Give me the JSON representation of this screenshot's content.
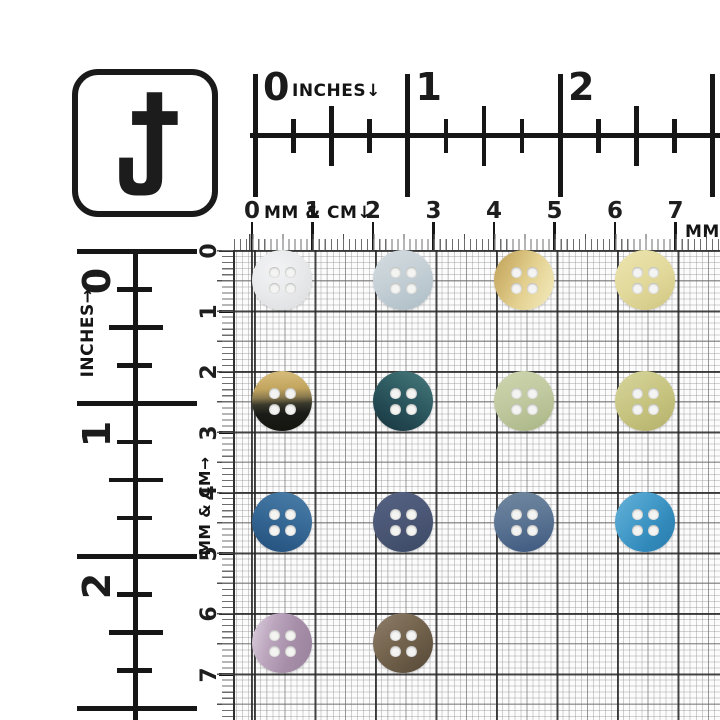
{
  "logo": {
    "letter": "J"
  },
  "rulers": {
    "top_inches": {
      "label": "INCHES↓",
      "numbers": [
        "0",
        "1",
        "2"
      ]
    },
    "top_cm": {
      "label": "MM & CM↓",
      "numbers": [
        "0",
        "1",
        "2",
        "3",
        "4",
        "5",
        "6",
        "7"
      ],
      "right_label": "MM"
    },
    "left_inches": {
      "label": "INCHES→",
      "numbers": [
        "0",
        "1",
        "2"
      ]
    },
    "left_cm": {
      "label": "MM & CM→",
      "numbers": [
        "0",
        "1",
        "2",
        "3",
        "4",
        "5",
        "6",
        "7"
      ]
    }
  },
  "grid": {
    "cm_line_color": "#2f2f2f",
    "mm_line_color": "#878787",
    "paper_color": "#fcfcfc"
  },
  "buttons": [
    {
      "name": "white-pearl-button",
      "row": 1,
      "col": 1,
      "holes": 4,
      "bg": "radial-gradient(circle at 38% 32%, #f3f3f5 0%, #e9eaec 45%, #dbdcdf 100%)"
    },
    {
      "name": "pale-blue-gray-button",
      "row": 1,
      "col": 2,
      "holes": 4,
      "bg": "linear-gradient(155deg, #d4dce0 0%, #c5d0d6 45%, #adbdc6 100%)"
    },
    {
      "name": "gold-shell-button",
      "row": 1,
      "col": 3,
      "holes": 4,
      "bg": "linear-gradient(115deg, #bfa058 0%, #d3ba74 30%, #e4d191 55%, #eee3b0 85%, #e6d89c 100%)"
    },
    {
      "name": "pale-butter-yellow-button",
      "row": 1,
      "col": 4,
      "holes": 4,
      "bg": "linear-gradient(150deg, #ece5ae 0%, #e2d99c 50%, #d1c682 100%)"
    },
    {
      "name": "gold-black-two-tone-button",
      "row": 2,
      "col": 1,
      "holes": 4,
      "bg": "linear-gradient(178deg, #d7bd7d 0%, #c2a55e 30%, #8a7a4e 44%, #3a392c 55%, #1b1c18 70%, #14150f 100%)"
    },
    {
      "name": "dark-teal-button",
      "row": 2,
      "col": 2,
      "holes": 4,
      "bg": "linear-gradient(210deg, #4a7b7c 0%, #305e64 40%, #224750 72%, #18343e 100%)"
    },
    {
      "name": "sage-pearl-button",
      "row": 2,
      "col": 3,
      "holes": 4,
      "bg": "linear-gradient(160deg, #cfd6b0 0%, #bfc89e 50%, #a9b586 100%)"
    },
    {
      "name": "pale-olive-khaki-button",
      "row": 2,
      "col": 4,
      "holes": 4,
      "bg": "linear-gradient(150deg, #d7d59c 0%, #c6c37f 55%, #b3b16a 100%)"
    },
    {
      "name": "steel-blue-button",
      "row": 3,
      "col": 1,
      "holes": 4,
      "bg": "linear-gradient(200deg, #4b7fa9 0%, #3a6d99 40%, #2c5b88 75%, #24507b 100%)"
    },
    {
      "name": "slate-navy-button",
      "row": 3,
      "col": 2,
      "holes": 4,
      "bg": "linear-gradient(160deg, #576384 0%, #495573 55%, #3b4967 100%)"
    },
    {
      "name": "dusty-blue-button",
      "row": 3,
      "col": 3,
      "holes": 4,
      "bg": "linear-gradient(170deg, #71889f 0%, #5d7694 45%, #4a6488 80%, #3f597f 100%)"
    },
    {
      "name": "cerulean-blue-button",
      "row": 3,
      "col": 4,
      "holes": 4,
      "bg": "linear-gradient(130deg, #66b2d8 0%, #449bc9 42%, #3189ba 70%, #2a7cab 100%)"
    },
    {
      "name": "lavender-mauve-button",
      "row": 4,
      "col": 1,
      "holes": 4,
      "bg": "linear-gradient(105deg, #ddd0de 0%, #bca6be 32%, #a78fa9 62%, #99829c 100%)"
    },
    {
      "name": "taupe-brown-button",
      "row": 4,
      "col": 2,
      "holes": 4,
      "bg": "linear-gradient(140deg, #8e7e6b 0%, #75654f 45%, #5f513e 82%, #564939 100%)"
    }
  ],
  "hole_color": "#f4f4f2"
}
